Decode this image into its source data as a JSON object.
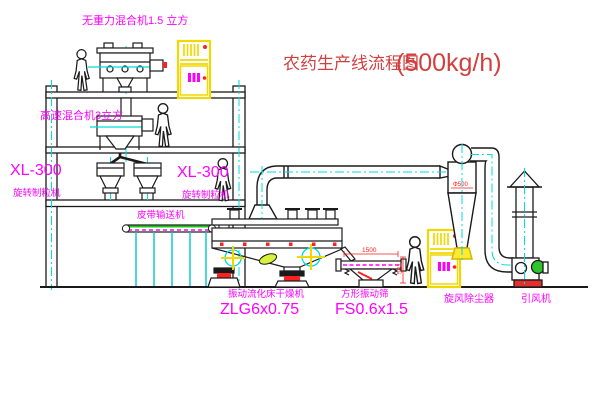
{
  "title": {
    "text": "农药生产线流程图",
    "capacity": "(500kg/h)"
  },
  "equipment": {
    "top_mixer": {
      "label": "无重力混合机1.5 立方"
    },
    "high_speed_mixer": {
      "label": "高速混合机3立方"
    },
    "granulator_left": {
      "model": "XL-300",
      "name": "旋转制粒机"
    },
    "granulator_center": {
      "model": "XL-300",
      "name": "旋转制粒机"
    },
    "belt_conveyor": {
      "label": "皮带输送机"
    },
    "fluid_bed_dryer": {
      "name": "振动流化床干燥机",
      "model": "ZLG6x0.75"
    },
    "vibrating_screen": {
      "name": "方形振动筛",
      "model": "FS0.6x1.5"
    },
    "cyclone": {
      "label": "旋风除尘器"
    },
    "induced_fan": {
      "label": "引风机"
    }
  },
  "dimensions": {
    "screen_length": "1500",
    "screen_height": "541",
    "cyclone_dia": "Φ500"
  },
  "colors": {
    "label_magenta": "#ff00ff",
    "title_red": "#d23f3f",
    "centerline_cyan": "#00dcdc",
    "cabinet_yellow": "#f0d800",
    "outline_black": "#1a1a1a",
    "accent_red": "#ff2020",
    "belt_green": "#19c819"
  }
}
